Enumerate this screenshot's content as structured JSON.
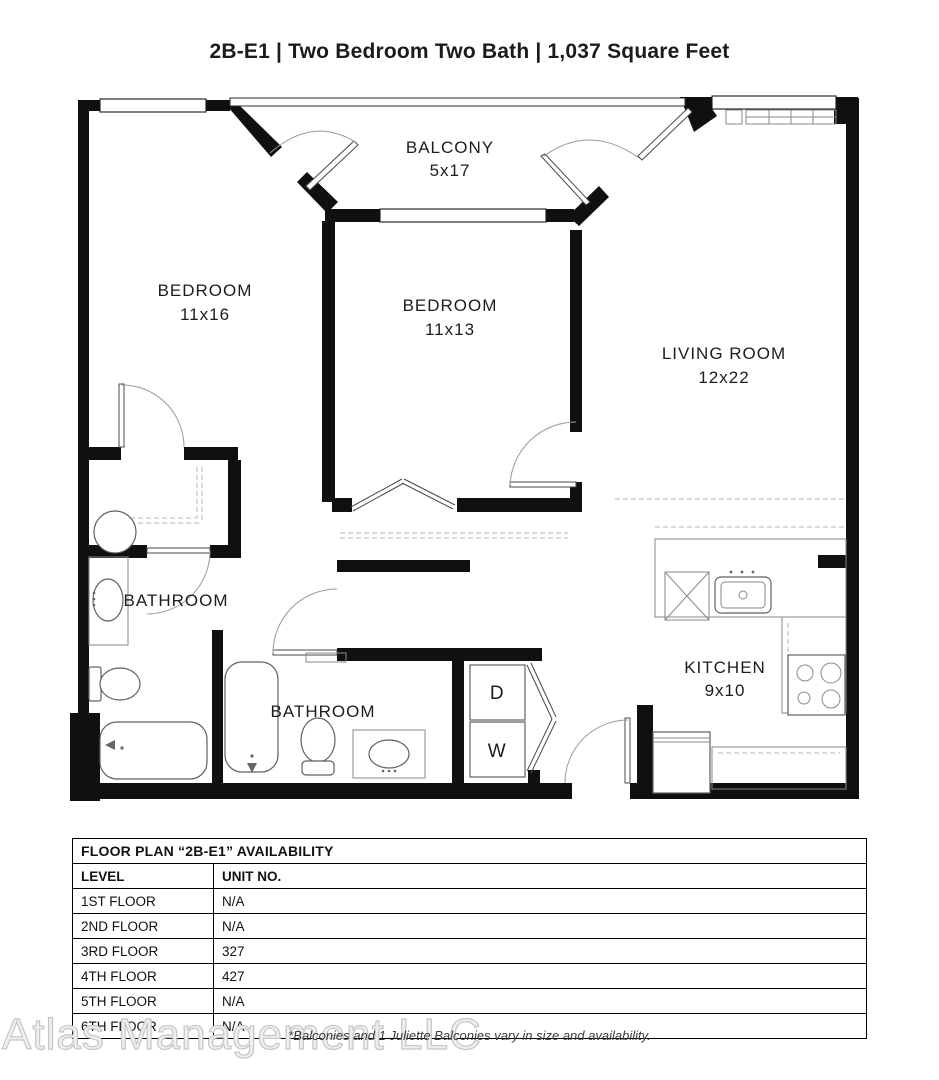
{
  "page": {
    "title": "2B-E1 | Two Bedroom Two Bath | 1,037 Square Feet"
  },
  "plan": {
    "rooms": [
      {
        "name": "BALCONY",
        "dims": "5x17"
      },
      {
        "name": "BEDROOM",
        "dims": "11x16"
      },
      {
        "name": "BEDROOM",
        "dims": "11x13"
      },
      {
        "name": "LIVING ROOM",
        "dims": "12x22"
      },
      {
        "name": "BATHROOM",
        "dims": ""
      },
      {
        "name": "BATHROOM",
        "dims": ""
      },
      {
        "name": "KITCHEN",
        "dims": "9x10"
      }
    ],
    "appliances": {
      "dryer": "D",
      "washer": "W"
    }
  },
  "availability": {
    "title": "FLOOR PLAN “2B-E1” AVAILABILITY",
    "columns": {
      "level": "LEVEL",
      "unit": "UNIT NO."
    },
    "rows": [
      {
        "level": "1ST FLOOR",
        "unit": "N/A"
      },
      {
        "level": "2ND FLOOR",
        "unit": "N/A"
      },
      {
        "level": "3RD FLOOR",
        "unit": "327"
      },
      {
        "level": "4TH FLOOR",
        "unit": "427"
      },
      {
        "level": "5TH FLOOR",
        "unit": "N/A"
      },
      {
        "level": "6TH FLOOR",
        "unit": "N/A"
      }
    ]
  },
  "footnote": "*Balconies and 1 Juliette Balconies vary in size and availability.",
  "watermark": "Atlas Management LLC"
}
